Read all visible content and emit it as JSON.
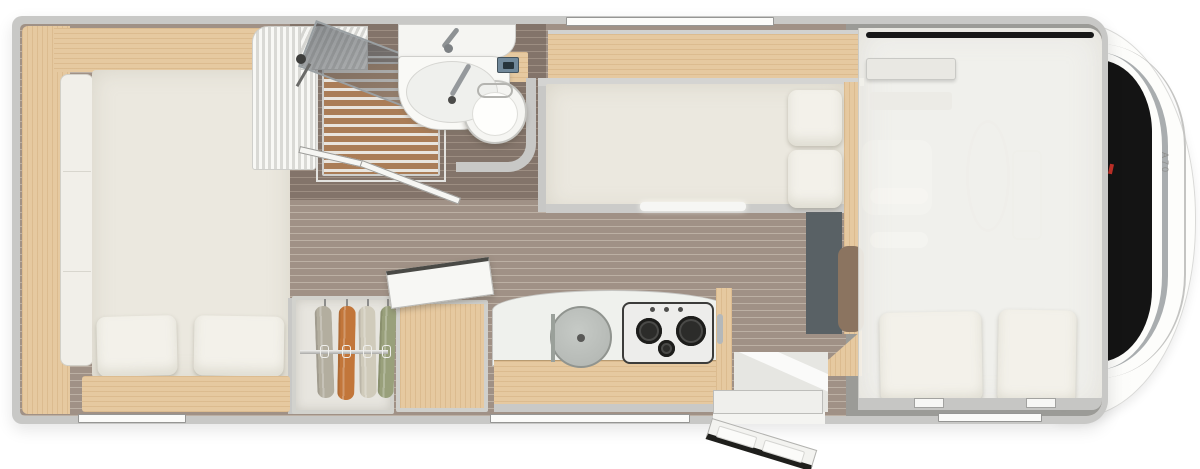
{
  "vehicle": {
    "model_label": "A70"
  },
  "fixtures": [
    "rear-double-bed",
    "bed-pillows",
    "tall-cupboard",
    "overhead-locker",
    "wardrobe-hanging-clothes",
    "storage-chest-open-lid",
    "shower-cabin",
    "shower-glass-door",
    "washbasin",
    "toilet",
    "toilet-control-panel",
    "middle-single-bed",
    "kitchen-counter",
    "kitchen-sink-lid",
    "gas-hob",
    "entrance-door-open",
    "entry-step",
    "overcab-drop-down-bed",
    "cab-steering-wheel",
    "cab-windshield",
    "window-markers"
  ],
  "colors": {
    "wall": "#c8c8c6",
    "wood1": "#e6c9a0",
    "floor1": "#a09186",
    "floor2": "#bcb0a4",
    "dfloor1": "#83746a",
    "dfloor2": "#9d8e82",
    "slat1": "#aa7d57",
    "slat2": "#e9e5de",
    "mattress": "#ebe8df",
    "pillow": "#f3f1ea",
    "cupboard": "#f1efe9",
    "counter": "#eff1ed",
    "stovedark": "#2c2c2a",
    "sinklid": "#bcc0bc",
    "anthracite": "#596165",
    "seatbrown": "#8b7460",
    "chrome": "#a9adaf",
    "windshield": "#141414",
    "accent": "#c03028",
    "garment1": "#b3ae9f",
    "garment2": "#c2763a",
    "garment3": "#d0cbbb",
    "garment4": "#99a07b"
  }
}
